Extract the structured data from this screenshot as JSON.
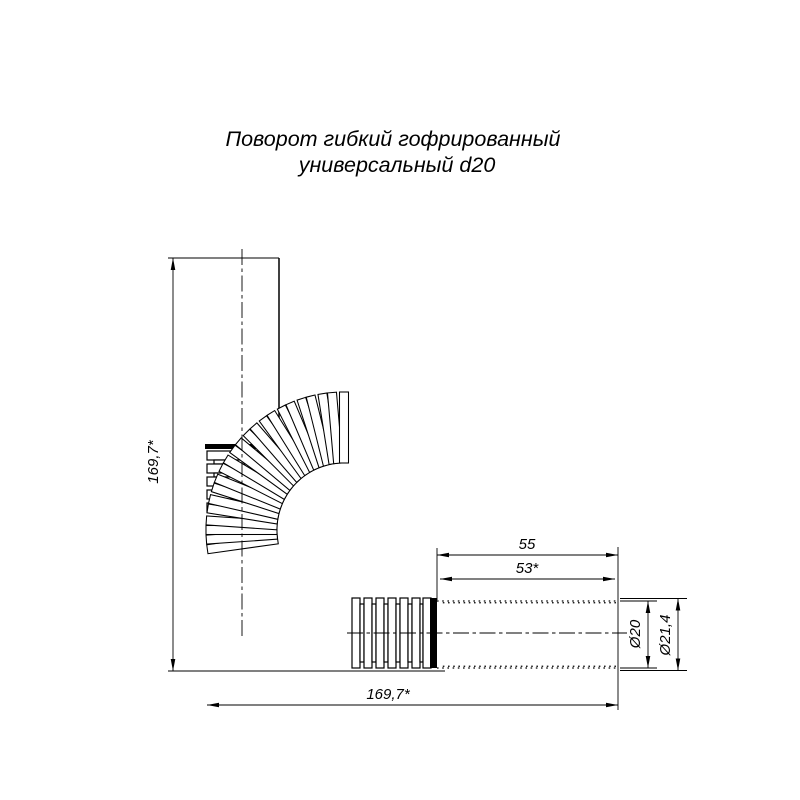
{
  "title": {
    "line1": "Поворот гибкий гофрированный",
    "line2": "универсальный d20"
  },
  "dims": {
    "height": "169,7*",
    "length": "169,7*",
    "end_length": "55",
    "end_length_star": "53*",
    "diameter_nominal": "Ø20",
    "diameter_outer": "Ø21,4"
  },
  "colors": {
    "line": "#000000",
    "background": "#ffffff"
  }
}
